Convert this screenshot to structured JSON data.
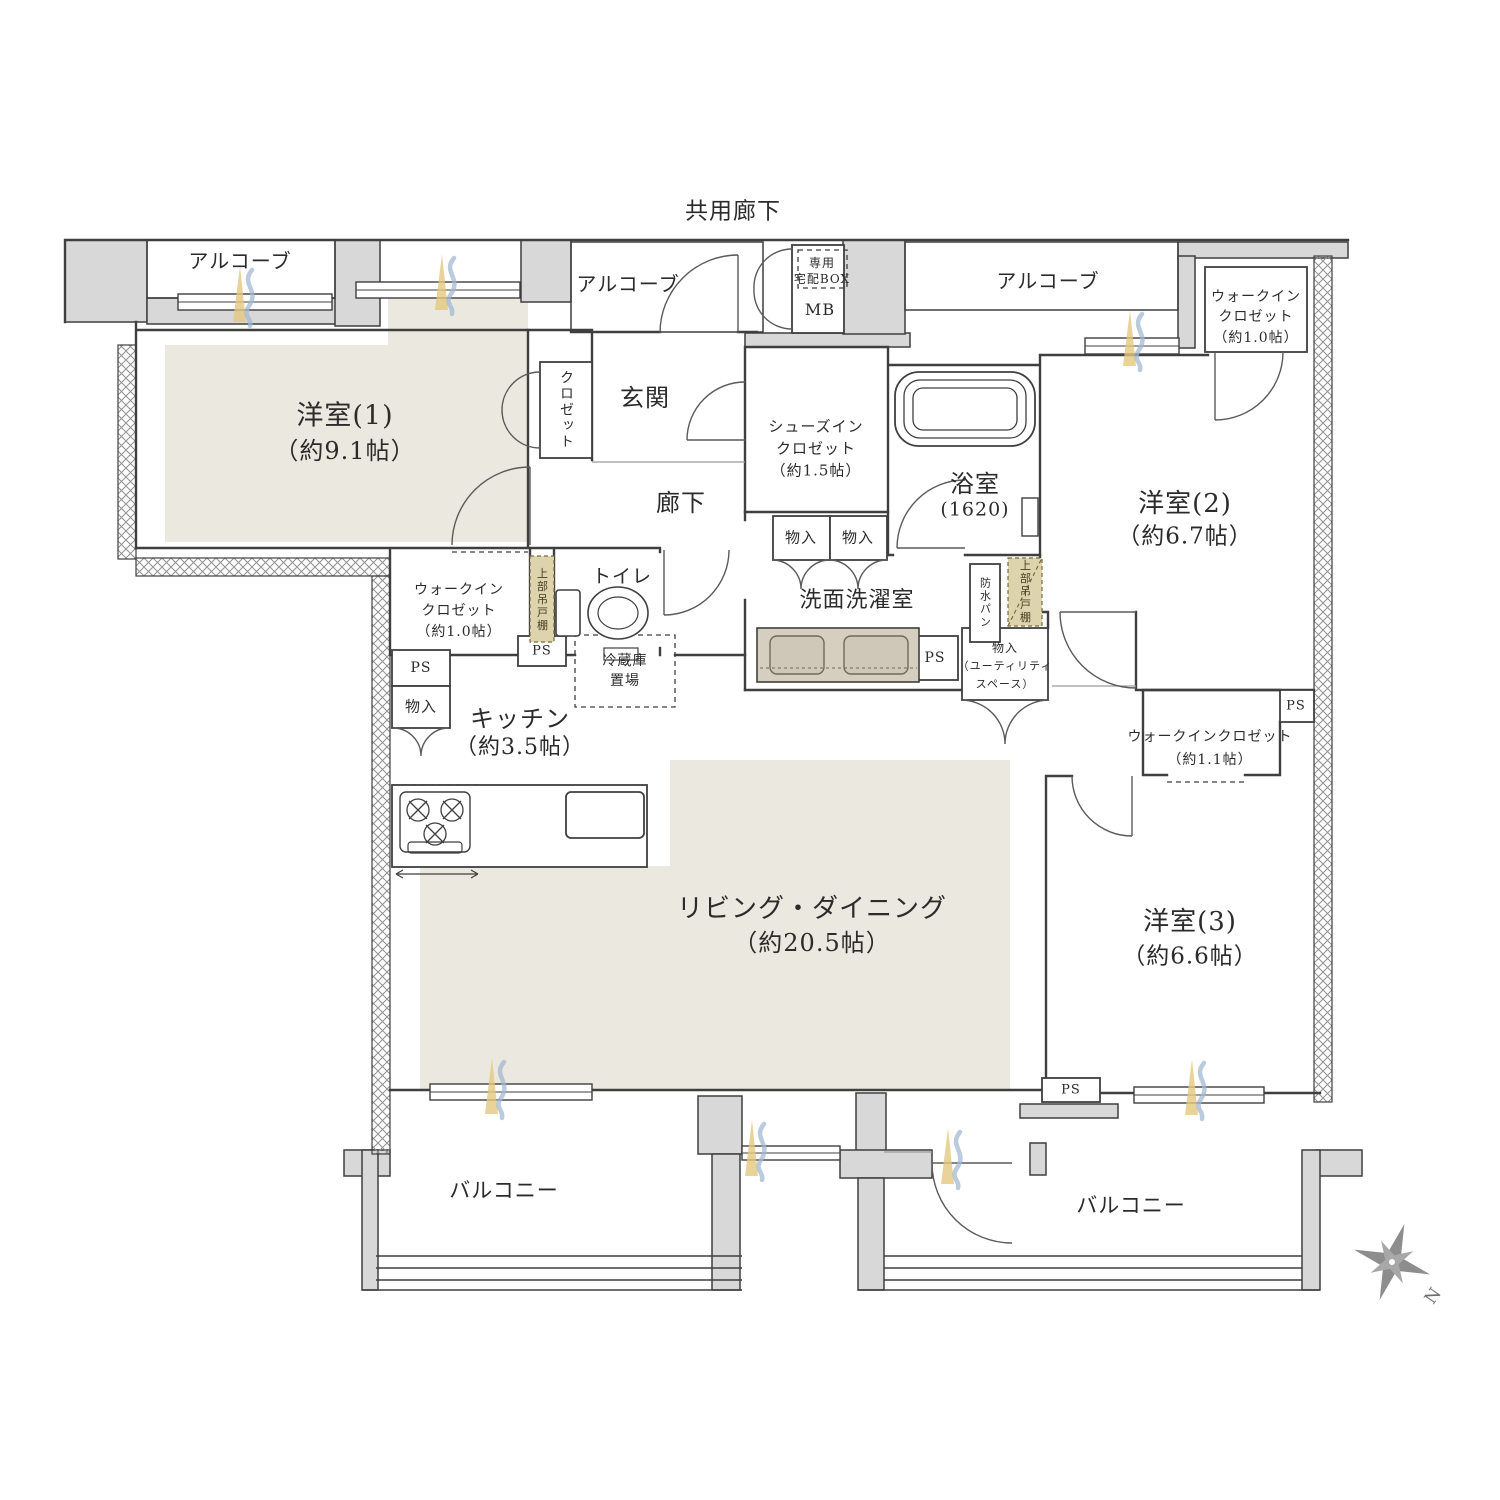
{
  "title": "マンション間取り図（3LDK＋ウォークインクロゼット）",
  "colors": {
    "wall_gray": "#d8d8d8",
    "line_dark": "#3f3f3f",
    "room_beige": "#ebe8df",
    "counter_tan": "#d6cfc0",
    "cabinet_tan": "#ddd3ac",
    "window_yellow": "#e3c87e",
    "window_blue": "#a3b9d2",
    "compass_gray": "#8d8d8d"
  },
  "labels": {
    "common_corridor": "共用廊下",
    "alcove_left": "アルコーブ",
    "alcove_center": "アルコーブ",
    "alcove_right": "アルコーブ",
    "delivery_box": [
      "専用",
      "宅配BOX"
    ],
    "mb": "MB",
    "wic_top_right": [
      "ウォークイン",
      "クロゼット",
      "（約1.0帖）"
    ],
    "room1": [
      "洋室(1)",
      "（約9.1帖）"
    ],
    "closet": "クロゼット",
    "genkan": "玄関",
    "shoes_closet": [
      "シューズイン",
      "クロゼット",
      "（約1.5帖）"
    ],
    "bathroom": [
      "浴室",
      "(1620)"
    ],
    "room2": [
      "洋室(2)",
      "（約6.7帖）"
    ],
    "corridor": "廊下",
    "toilet": "トイレ",
    "wic_left": [
      "ウォークイン",
      "クロゼット",
      "（約1.0帖）"
    ],
    "upper_cabinet_left": "上部吊戸棚",
    "upper_cabinet_right": "上部吊戸棚",
    "waterproof_pan": "防水パン",
    "storage_kitchen": "物入",
    "storage_wash_1": "物入",
    "storage_wash_2": "物入",
    "storage_utility": [
      "物入",
      "（ユーティリティ",
      "スペース）"
    ],
    "laundry": "洗面洗濯室",
    "ps": "PS",
    "fridge_space": [
      "冷蔵庫",
      "置場"
    ],
    "kitchen": [
      "キッチン",
      "（約3.5帖）"
    ],
    "wic_right": [
      "ウォークインクロゼット",
      "（約1.1帖）"
    ],
    "living": [
      "リビング・ダイニング",
      "（約20.5帖）"
    ],
    "room3": [
      "洋室(3)",
      "（約6.6帖）"
    ],
    "balcony_left": "バルコニー",
    "balcony_right": "バルコニー",
    "compass_north": "N"
  }
}
